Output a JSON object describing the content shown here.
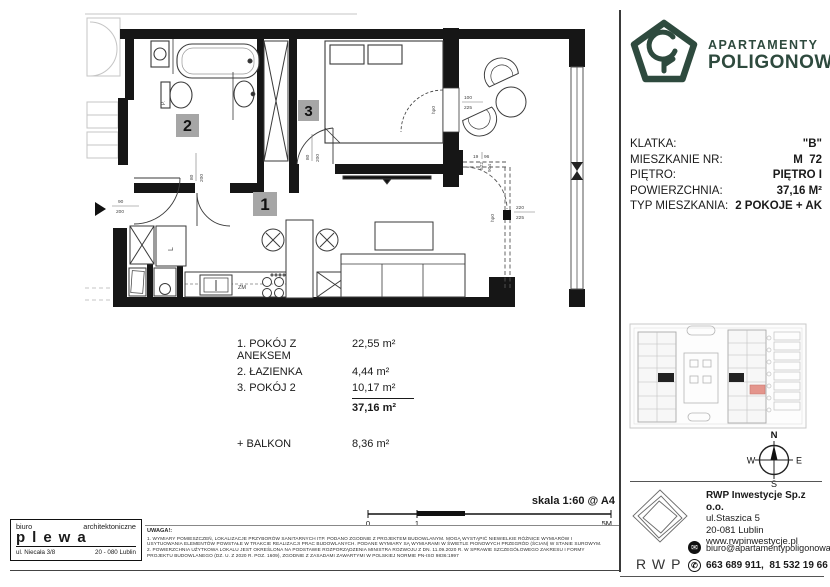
{
  "brand": {
    "line1": "APARTAMENTY",
    "line2": "POLIGONOWA",
    "color": "#2e4a3e"
  },
  "unit_info": {
    "rows": [
      {
        "label": "KLATKA:",
        "value": "\"B\""
      },
      {
        "label": "MIESZKANIE NR:",
        "value": "M  72"
      },
      {
        "label": "PIĘTRO:",
        "value": "PIĘTRO I"
      },
      {
        "label": "POWIERZCHNIA:",
        "value": "37,16 M²"
      },
      {
        "label": "TYP MIESZKANIA:",
        "value": "2 POKOJE + AK"
      }
    ]
  },
  "room_schedule": {
    "items": [
      {
        "label": "1. POKÓJ Z ANEKSEM",
        "area": "22,55 m²"
      },
      {
        "label": "2. ŁAZIENKA",
        "area": "4,44 m²"
      },
      {
        "label": "3. POKÓJ 2",
        "area": "10,17 m²"
      }
    ],
    "total_area": "37,16 m²",
    "balcony_label": "+ BALKON",
    "balcony_area": "8,36 m²"
  },
  "floor_plan": {
    "room_labels": {
      "r1": "1",
      "r2": "2",
      "r3": "3"
    },
    "fixture_labels": {
      "sink": "ZM",
      "cabinet": "L",
      "washer": "P."
    },
    "dims": {
      "entrance": {
        "w": "90",
        "h": "200"
      },
      "bath_door": {
        "w": "80",
        "h": "200"
      },
      "room3_door": {
        "w": "80",
        "h": "200"
      },
      "balcony_door": {
        "w": "100",
        "h": "225"
      },
      "living_door": {
        "w": "220",
        "h": "225"
      },
      "balcony_side": {
        "a": "522",
        "b": "904"
      },
      "corner": {
        "a": "19",
        "b": "96"
      },
      "parapet": "hp0"
    }
  },
  "site_plan": {
    "highlight_color": "#e4958c"
  },
  "compass": {
    "n": "N",
    "e": "E",
    "s": "S",
    "w": "W"
  },
  "scale_bar": {
    "label": "skala 1:60 @ A4",
    "tick0": "0",
    "tick1": "1",
    "tick5": "5M"
  },
  "architect": {
    "line1_left": "biuro",
    "line1_right": "architektoniczne",
    "name": "plewa",
    "addr_left": "ul. Niecała 3/8",
    "addr_right": "20 - 080 Lublin"
  },
  "notes": {
    "title": "UWAGA!:",
    "lines": [
      "1. WYMIARY POMIESZCZEŃ, LOKALIZACJE PRZYBORÓW SANITARNYCH ITP. PODANO ZGODNIE Z PROJEKTEM BUDOWLANYM. MOGĄ WYSTĄPIĆ NIEWIELKIE RÓŻNICE WYMIARÓW I",
      "USYTUOWANIA ELEMENTÓW POWSTAŁE W TRAKCIE REALIZACJI PRAC BUDOWLANYCH. PODANE WYMIARY SĄ WYMIARAMI W ŚWIETLE PIONOWYCH PRZEGRÓD (ŚCIAN) W STANIE SUROWYM.",
      "2. POWIERZCHNIA UŻYTKOWA LOKALU JEST OKREŚLONA NA PODSTAWIE ROZPORZĄDZENIA MINISTRA ROZWOJU Z DN. 11.09.2020 R. W SPRAWIE SZCZEGÓŁOWEGO ZAKRESU I FORMY",
      "PROJEKTU BUDOWLANEGO (DZ. U. Z 2020 R. POZ. 1609), ZGODNIE Z ZASADAMI ZAWARTYMI W POLSKIEJ NORMIE PN-ISO 9836:1997"
    ]
  },
  "developer": {
    "company": "RWP Inwestycje Sp.z o.o.",
    "address1": "ul.Staszica 5",
    "address2": "20-081 Lublin",
    "website": "www.rwpinwestycje.pl",
    "email": "biuro@apartamentypoligonowa.pl",
    "phones": "663 689 911,  81 532 19 66",
    "logo_text": "RWP"
  }
}
